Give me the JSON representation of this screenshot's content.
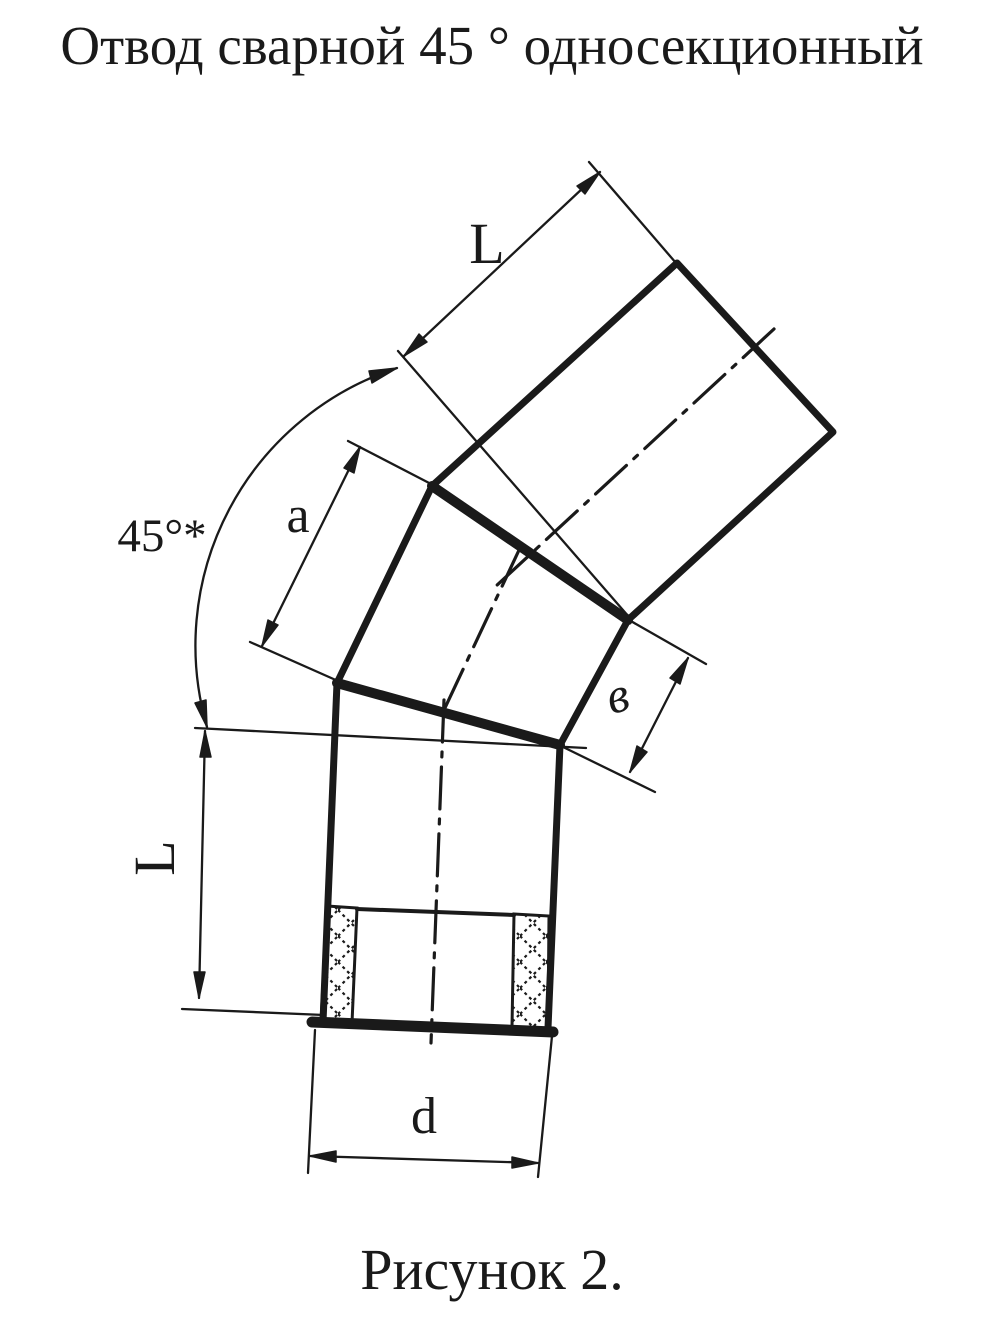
{
  "page": {
    "background": "#ffffff",
    "ink": "#1a1a1a"
  },
  "header": {
    "title": "Отвод сварной 45 ° односекционный"
  },
  "figure": {
    "caption": "Рисунок 2."
  },
  "dims": {
    "upper_length": "L",
    "segment_a": "a",
    "angle": "45°*",
    "inner_side": "в",
    "lower_length": "L",
    "diameter": "d"
  }
}
